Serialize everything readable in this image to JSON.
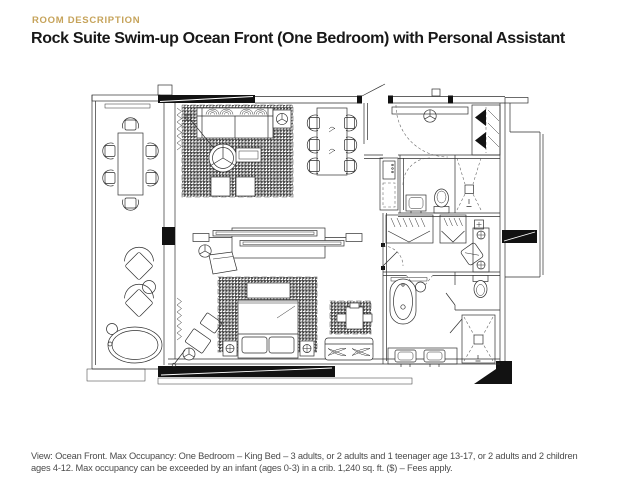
{
  "page": {
    "background": "#ffffff",
    "width": 640,
    "height": 486
  },
  "header": {
    "eyebrow": "ROOM DESCRIPTION",
    "eyebrow_color": "#c6a35a",
    "title": "Rock Suite Swim-up Ocean Front (One Bedroom) with Personal Assistant",
    "title_color": "#181818"
  },
  "floor_plan": {
    "type": "architectural-plan-drawing",
    "line_color": "#2f2f2f",
    "wall_fill": "#121212",
    "areas": [
      "terrace",
      "living-room",
      "dining-area",
      "tv-console",
      "bedroom",
      "entry-hall",
      "minibar-counter",
      "powder-room",
      "shower-room",
      "walk-in-closet",
      "bathroom",
      "water-closet",
      "plunge-pool"
    ]
  },
  "caption": {
    "color": "#4b4b4b",
    "lines": [
      "View: Ocean Front. Max Occupancy: One Bedroom – King Bed – 3 adults, or 2 adults and 1 teenager age 13-17, or 2 adults and 2 children",
      "ages 4-12. Max occupancy can be exceeded by an infant (ages 0-3) in a crib. 1,240 sq. ft. ($) – Fees apply."
    ]
  }
}
